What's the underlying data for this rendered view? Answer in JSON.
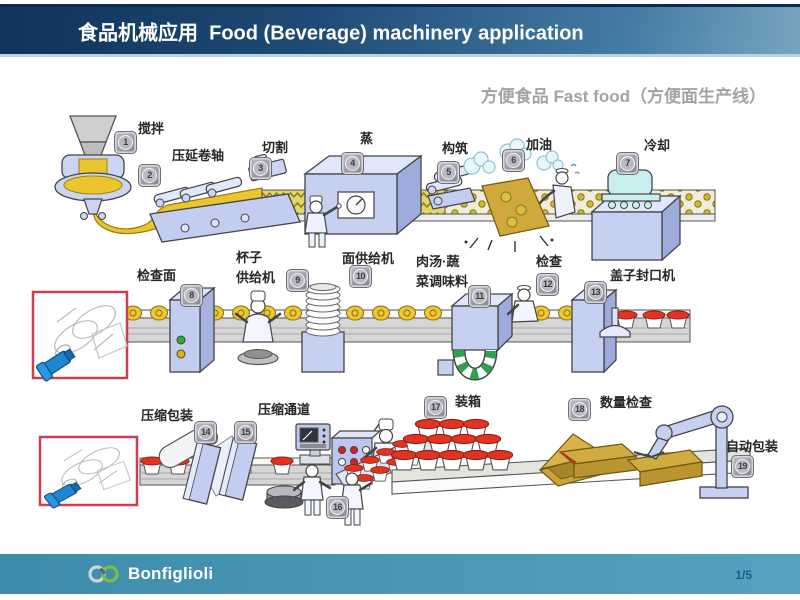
{
  "header": {
    "title": "食品机械应用  Food (Beverage) machinery application"
  },
  "subtitle": "方便食品 Fast food（方便面生产线）",
  "stations": [
    {
      "num": "1",
      "label": "搅拌"
    },
    {
      "num": "2",
      "label": "压延卷轴"
    },
    {
      "num": "3",
      "label": "切割"
    },
    {
      "num": "4",
      "label": "蒸"
    },
    {
      "num": "5",
      "label": "构筑"
    },
    {
      "num": "6",
      "label": "加油"
    },
    {
      "num": "7",
      "label": "冷却"
    },
    {
      "num": "8",
      "label": "检查面"
    },
    {
      "num": "9",
      "label": "杯子\n供给机"
    },
    {
      "num": "10",
      "label": "面供给机"
    },
    {
      "num": "11",
      "label": "肉汤·蔬\n菜调味料"
    },
    {
      "num": "12",
      "label": "检查"
    },
    {
      "num": "13",
      "label": "盖子封口机"
    },
    {
      "num": "14",
      "label": "压缩包装"
    },
    {
      "num": "15",
      "label": "压缩通道"
    },
    {
      "num": "16",
      "label": ""
    },
    {
      "num": "17",
      "label": "装箱"
    },
    {
      "num": "18",
      "label": "数量检查"
    },
    {
      "num": "19",
      "label": "自动包装"
    }
  ],
  "footer": {
    "logo_text": "Bonfiglioli",
    "page_number": "1/5"
  },
  "colors": {
    "header_navy": "#10335a",
    "footer_teal": "#3e8cab",
    "callout_red": "#c94050",
    "noodle_yellow": "#e9c62e",
    "lid_red": "#e23222",
    "machine_blue": "#c5cff1",
    "box_tan": "#c9a23a"
  }
}
